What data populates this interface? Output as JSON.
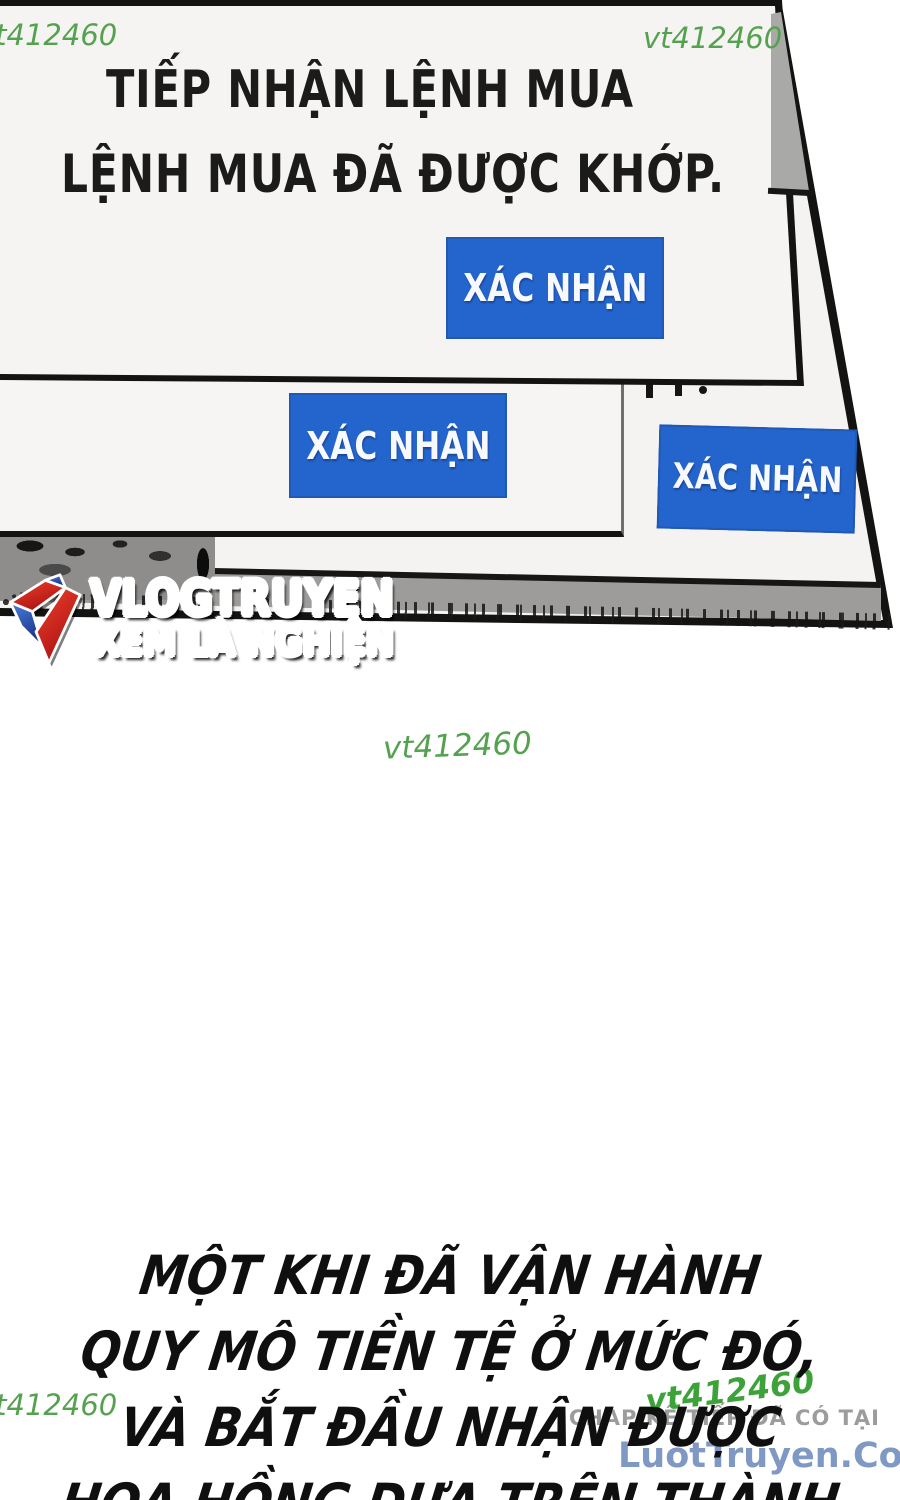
{
  "watermark": {
    "top_left": "vt412460",
    "top_right": "vt412460",
    "center": "vt412460",
    "bottom_left": "vt412460",
    "bottom_right": "vt412460"
  },
  "dialogs": {
    "dialog1": {
      "line1": "TIẾP NHẬN LỆNH MUA",
      "line2": "LỆNH MUA ĐÃ ĐƯỢC KHỚP.",
      "button": "XÁC NHẬN"
    },
    "dialog2": {
      "button": "XÁC NHẬN"
    },
    "dialog3": {
      "button": "XÁC NHẬN"
    }
  },
  "logo": {
    "title": "VLOGTRUYEN",
    "subtitle": "XEM LÀ NGHIỆN"
  },
  "narration": {
    "lines": [
      "MỘT KHI ĐÃ VẬN HÀNH",
      "QUY MÔ TIỀN TỆ Ở MỨC ĐÓ,",
      "VÀ BẮT ĐẦU NHẬN ĐƯỢC",
      "HOA HỒNG DỰA TRÊN THÀNH"
    ]
  },
  "footer": {
    "promo_line": "CHAP KẾ TIẾP ĐÃ CÓ TẠI",
    "site": "LuotTruyen.Com"
  },
  "colors": {
    "button_blue": "#2465cd",
    "watermark_green": "#54a24f",
    "watermark_green_dark": "#3da23a",
    "logo_red": "#cf1c1c",
    "logo_blue": "#2433b8",
    "site_blue": "#7f99c4",
    "promo_gray": "#9c9c9c",
    "panel_gray": "#9d9c9a",
    "ink_black": "#131312"
  }
}
